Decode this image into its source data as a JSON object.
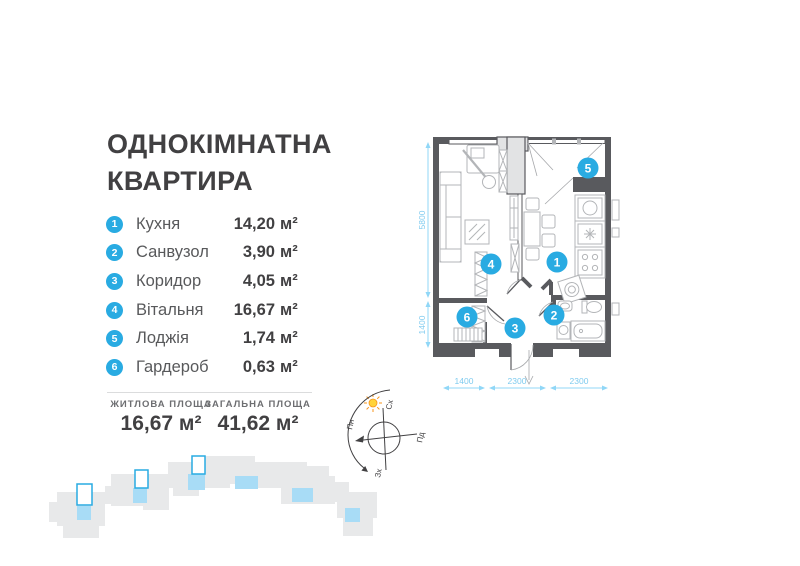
{
  "title": {
    "line1": "ОДНОКІМНАТНА",
    "line2": "КВАРТИРА"
  },
  "rooms": [
    {
      "num": "1",
      "name": "Кухня",
      "area": "14,20",
      "unit": "м²"
    },
    {
      "num": "2",
      "name": "Санвузол",
      "area": "3,90",
      "unit": "м²"
    },
    {
      "num": "3",
      "name": "Коридор",
      "area": "4,05",
      "unit": "м²"
    },
    {
      "num": "4",
      "name": "Вітальня",
      "area": "16,67",
      "unit": "м²"
    },
    {
      "num": "5",
      "name": "Лоджія",
      "area": "1,74",
      "unit": "м²"
    },
    {
      "num": "6",
      "name": "Гардероб",
      "area": "0,63",
      "unit": "м²"
    }
  ],
  "summary": {
    "living_label": "ЖИТЛОВА ПЛОЩА",
    "living_value": "16,67 м²",
    "total_label": "ЗАГАЛЬНА ПЛОЩА",
    "total_value": "41,62 м²"
  },
  "plan": {
    "badges": {
      "b1": "1",
      "b2": "2",
      "b3": "3",
      "b4": "4",
      "b5": "5",
      "b6": "6"
    },
    "dims": {
      "height_main": "5800",
      "height_lower": "1400",
      "width_1": "1400",
      "width_2": "2300",
      "width_3": "2300"
    }
  },
  "compass": {
    "north": "Пн",
    "south": "Пд",
    "east": "Сх",
    "west": "Зх"
  },
  "colors": {
    "accent_blue": "#29ABE2",
    "dim_blue": "#90D7F7",
    "wall_gray": "#595A5E",
    "furniture_gray": "#B3B5B8",
    "footprint_gray": "#E8E9EA",
    "footprint_blue": "#A8DCF6",
    "text_dark": "#414042",
    "sun_yellow": "#FFD339"
  }
}
